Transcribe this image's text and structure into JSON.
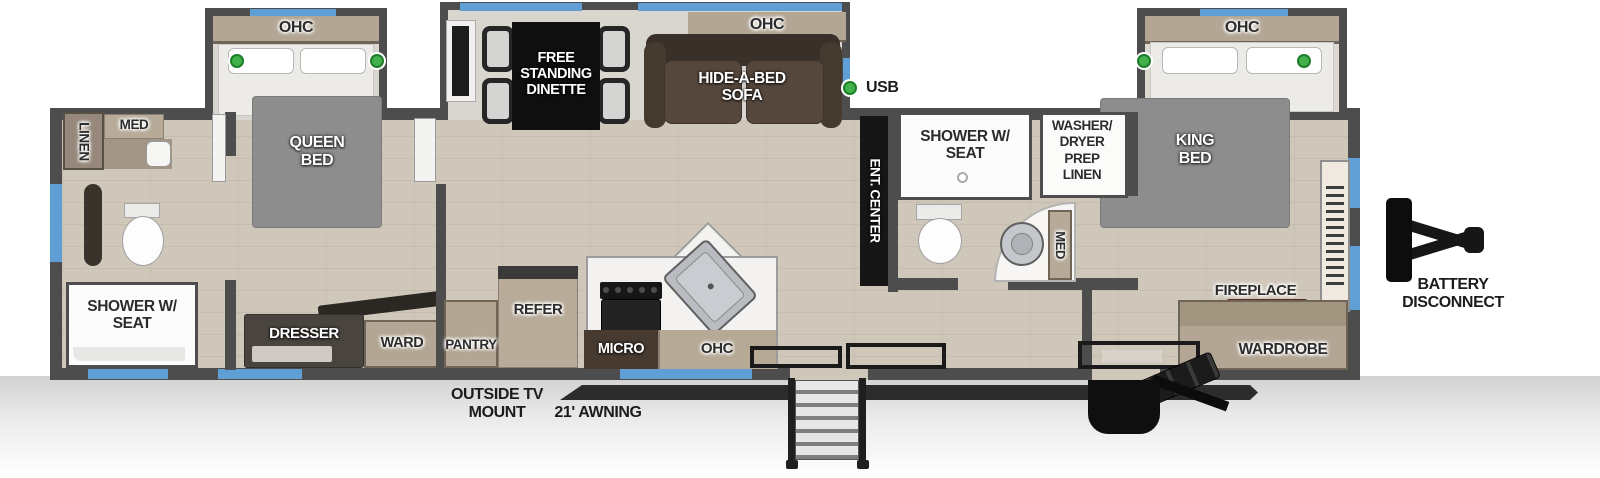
{
  "meta": {
    "title": "Travel trailer floor plan diagram"
  },
  "colors": {
    "wall": "#4d4d4d",
    "window_blue": "#5f9fd6",
    "wood_floor": "#cfc7ba",
    "slide_floor": "#d9d5cf",
    "cabinet_tan": "#b3a694",
    "cabinet_dark": "#4a443e",
    "sofa_brown": "#52443a",
    "bed_gray": "#8d8d8d",
    "indicator_green": "#41b14b",
    "ent_center_black": "#161616"
  },
  "slide_rear": {
    "ohc": "OHC",
    "bed": "QUEEN BED"
  },
  "rear_bath": {
    "linen": "LINEN",
    "med": "MED",
    "shower": "SHOWER W/ SEAT"
  },
  "rear_bedroom": {
    "dresser": "DRESSER",
    "ward": "WARD"
  },
  "living": {
    "dinette": "FREE STANDING DINETTE",
    "ohc": "OHC",
    "sofa": "HIDE-A-BED SOFA",
    "usb": "USB",
    "ent_center": "ENT. CENTER"
  },
  "kitchen": {
    "refer": "REFER",
    "pantry": "PANTRY",
    "micro": "MICRO",
    "ohc": "OHC"
  },
  "mid_bath": {
    "shower": "SHOWER W/ SEAT",
    "washer_dryer": "WASHER/ DRYER PREP LINEN",
    "med": "MED"
  },
  "front_bedroom": {
    "ohc": "OHC",
    "bed": "KING BED",
    "fireplace": "FIREPLACE",
    "wardrobe": "WARDROBE"
  },
  "exterior": {
    "outside_tv_mount": "OUTSIDE TV MOUNT",
    "awning": "21' AWNING",
    "battery_disconnect": "BATTERY DISCONNECT"
  }
}
